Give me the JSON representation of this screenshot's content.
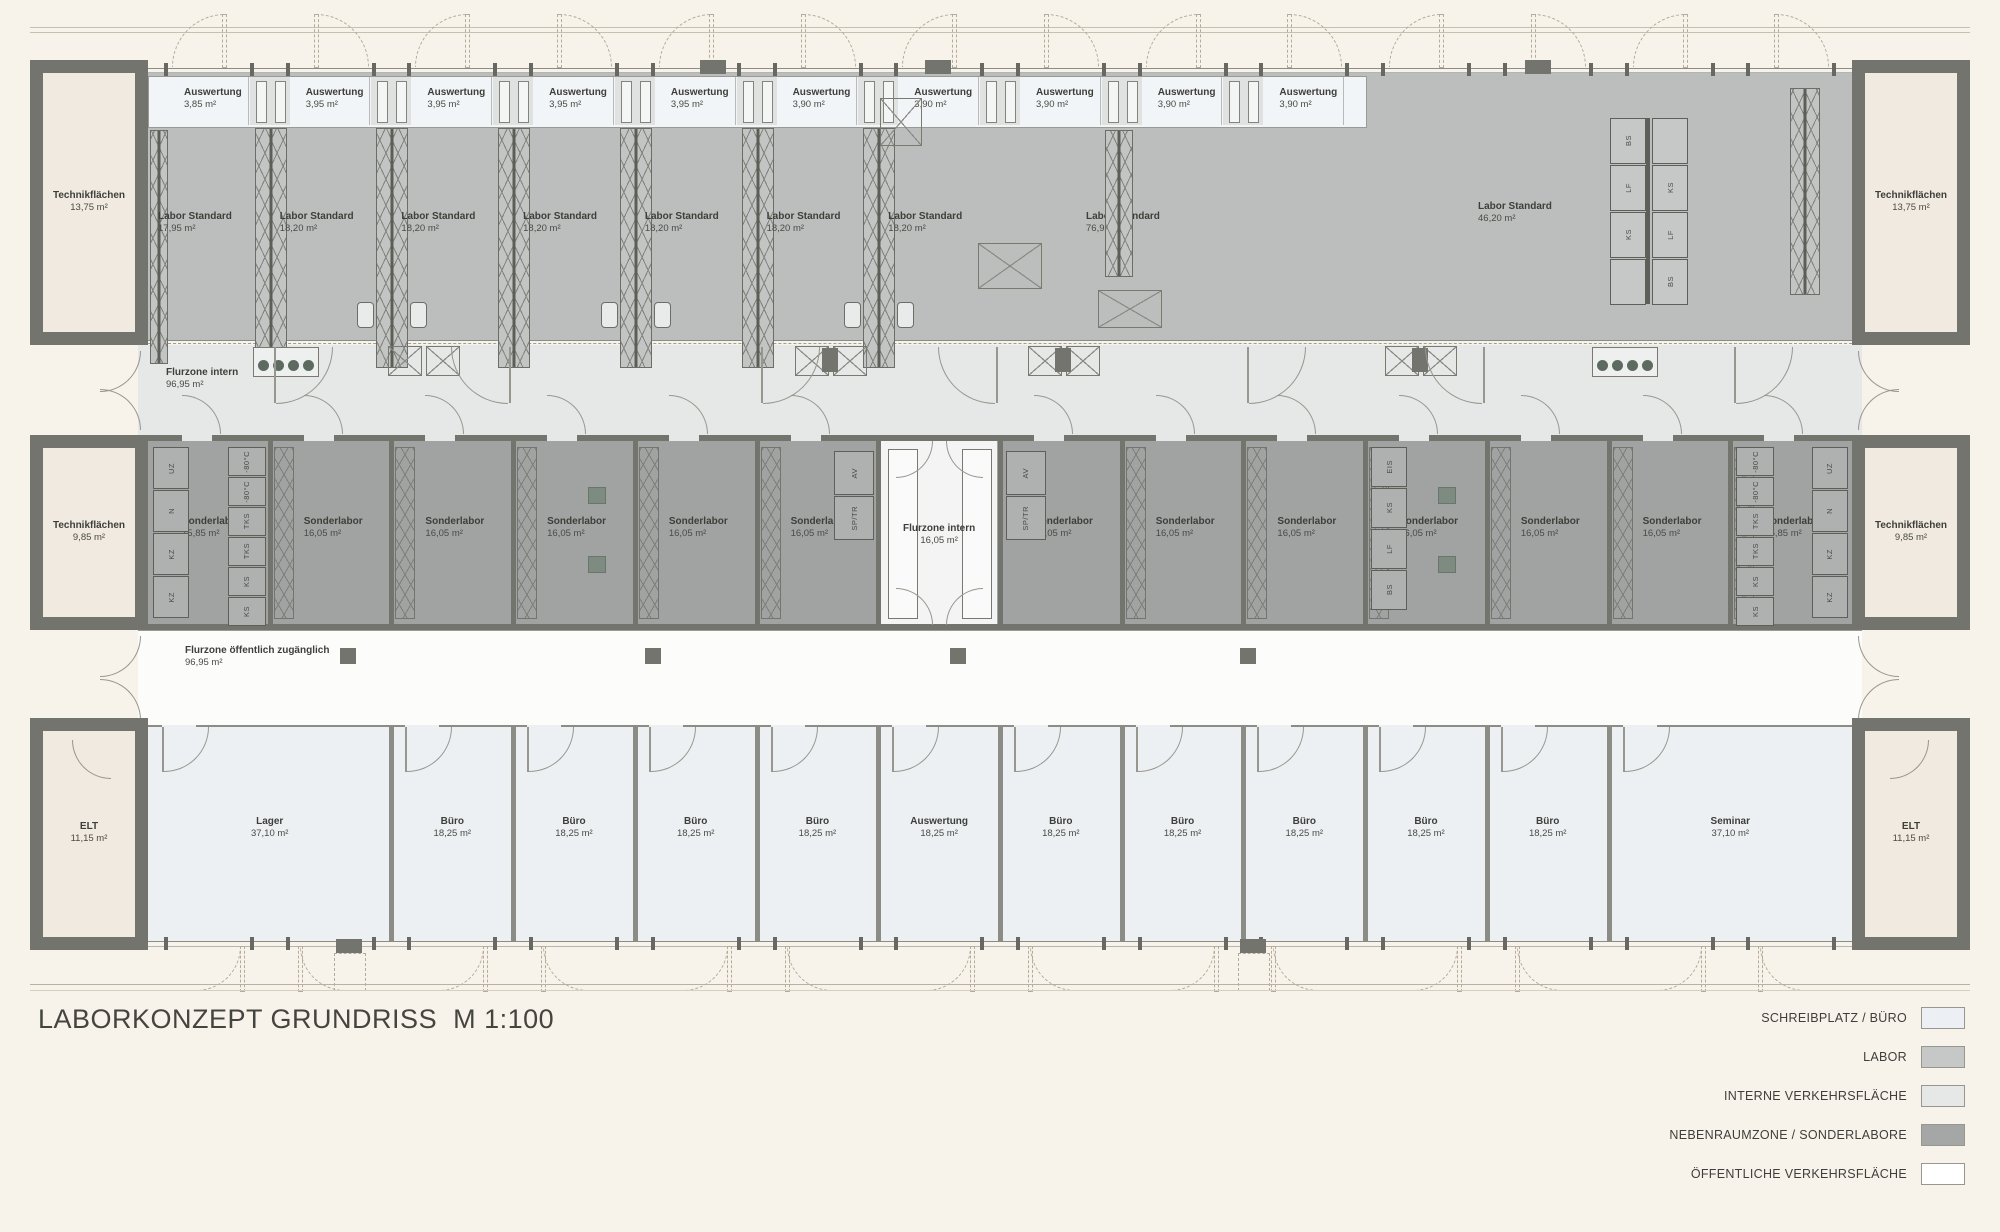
{
  "title": {
    "text": "LABORKONZEPT GRUNDRISS",
    "scale": "M 1:100"
  },
  "legend": [
    {
      "label": "SCHREIBPLATZ / BÜRO",
      "color": "#eceff4"
    },
    {
      "label": "LABOR",
      "color": "#c6c8c7"
    },
    {
      "label": "INTERNE VERKEHRSFLÄCHE",
      "color": "#e6e8e7"
    },
    {
      "label": "NEBENRAUMZONE / SONDERLABORE",
      "color": "#a4a7a6"
    },
    {
      "label": "ÖFFENTLICHE VERKEHRSFLÄCHE",
      "color": "#ffffff"
    }
  ],
  "plan": {
    "top_band": {
      "technik_left": {
        "name": "Technikflächen",
        "area": "13,75 m²"
      },
      "technik_right": {
        "name": "Technikflächen",
        "area": "13,75 m²"
      },
      "auswertung_rooms": [
        {
          "name": "Auswertung",
          "area": "3,85 m²"
        },
        {
          "name": "Auswertung",
          "area": "3,95 m²"
        },
        {
          "name": "Auswertung",
          "area": "3,95 m²"
        },
        {
          "name": "Auswertung",
          "area": "3,95 m²"
        },
        {
          "name": "Auswertung",
          "area": "3,95 m²"
        },
        {
          "name": "Auswertung",
          "area": "3,90 m²"
        },
        {
          "name": "Auswertung",
          "area": "3,90 m²"
        },
        {
          "name": "Auswertung",
          "area": "3,90 m²"
        },
        {
          "name": "Auswertung",
          "area": "3,90 m²"
        },
        {
          "name": "Auswertung",
          "area": "3,90 m²"
        }
      ],
      "labor_rooms": [
        {
          "name": "Labor Standard",
          "area": "17,95 m²"
        },
        {
          "name": "Labor Standard",
          "area": "18,20 m²"
        },
        {
          "name": "Labor Standard",
          "area": "18,20 m²"
        },
        {
          "name": "Labor Standard",
          "area": "18,20 m²"
        },
        {
          "name": "Labor Standard",
          "area": "18,20 m²"
        },
        {
          "name": "Labor Standard",
          "area": "18,20 m²"
        },
        {
          "name": "Labor Standard",
          "area": "18,20 m²"
        },
        {
          "name": "Labor Standard",
          "area": "76,95 m²"
        },
        {
          "name": "Labor Standard",
          "area": "46,20 m²"
        }
      ]
    },
    "corridor_intern": {
      "name": "Flurzone intern",
      "area": "96,95 m²"
    },
    "sonder_band": {
      "technik_left": {
        "name": "Technikflächen",
        "area": "9,85 m²"
      },
      "technik_right": {
        "name": "Technikflächen",
        "area": "9,85 m²"
      },
      "rooms_left": [
        {
          "name": "Sonderlabor",
          "area": "15,85 m²"
        },
        {
          "name": "Sonderlabor",
          "area": "16,05 m²"
        },
        {
          "name": "Sonderlabor",
          "area": "16,05 m²"
        },
        {
          "name": "Sonderlabor",
          "area": "16,05 m²"
        },
        {
          "name": "Sonderlabor",
          "area": "16,05 m²"
        },
        {
          "name": "Sonderlabor",
          "area": "16,05 m²"
        }
      ],
      "flur": {
        "name": "Flurzone intern",
        "area": "16,05 m²"
      },
      "rooms_right": [
        {
          "name": "Sonderlabor",
          "area": "16,05 m²"
        },
        {
          "name": "Sonderlabor",
          "area": "16,05 m²"
        },
        {
          "name": "Sonderlabor",
          "area": "16,05 m²"
        },
        {
          "name": "Sonderlabor",
          "area": "16,05 m²"
        },
        {
          "name": "Sonderlabor",
          "area": "16,05 m²"
        },
        {
          "name": "Sonderlabor",
          "area": "16,05 m²"
        },
        {
          "name": "Sonderlabor",
          "area": "15,85 m²"
        }
      ]
    },
    "corridor_public": {
      "name": "Flurzone öffentlich zugänglich",
      "area": "96,95 m²"
    },
    "office_band": {
      "elt_left": {
        "name": "ELT",
        "area": "11,15 m²"
      },
      "elt_right": {
        "name": "ELT",
        "area": "11,15 m²"
      },
      "rooms": [
        {
          "name": "Lager",
          "area": "37,10 m²",
          "span": 2
        },
        {
          "name": "Büro",
          "area": "18,25 m²",
          "span": 1
        },
        {
          "name": "Büro",
          "area": "18,25 m²",
          "span": 1
        },
        {
          "name": "Büro",
          "area": "18,25 m²",
          "span": 1
        },
        {
          "name": "Büro",
          "area": "18,25 m²",
          "span": 1
        },
        {
          "name": "Auswertung",
          "area": "18,25 m²",
          "span": 1
        },
        {
          "name": "Büro",
          "area": "18,25 m²",
          "span": 1
        },
        {
          "name": "Büro",
          "area": "18,25 m²",
          "span": 1
        },
        {
          "name": "Büro",
          "area": "18,25 m²",
          "span": 1
        },
        {
          "name": "Büro",
          "area": "18,25 m²",
          "span": 1
        },
        {
          "name": "Büro",
          "area": "18,25 m²",
          "span": 1
        },
        {
          "name": "Seminar",
          "area": "37,10 m²",
          "span": 2
        }
      ]
    },
    "equipment": {
      "lab_cluster_left": [
        "BS",
        "LF",
        "KS",
        ""
      ],
      "lab_cluster_right": [
        "",
        "KS",
        "LF",
        "BS"
      ],
      "sonder_end": [
        "UZ",
        "N",
        "KZ",
        "KZ"
      ],
      "sonder_cold": [
        "-80°C",
        "-80°C",
        "TKS",
        "TKS",
        "KS",
        "KS"
      ],
      "sonder_near_flur": [
        "AV",
        "SP/TR"
      ],
      "sonder_misc": [
        "EIS",
        "KS",
        "LF",
        "BS"
      ]
    },
    "colors": {
      "labor_fill": "#bcbebd",
      "sonder_fill": "#a0a3a2",
      "intern_corridor_fill": "#e6e8e7",
      "public_corridor_fill": "#fcfcfb",
      "office_fill": "#edf0f3",
      "auswertung_fill": "#f2f5f7",
      "technik_fill": "#f0eae0",
      "wall": "#74746e"
    }
  }
}
